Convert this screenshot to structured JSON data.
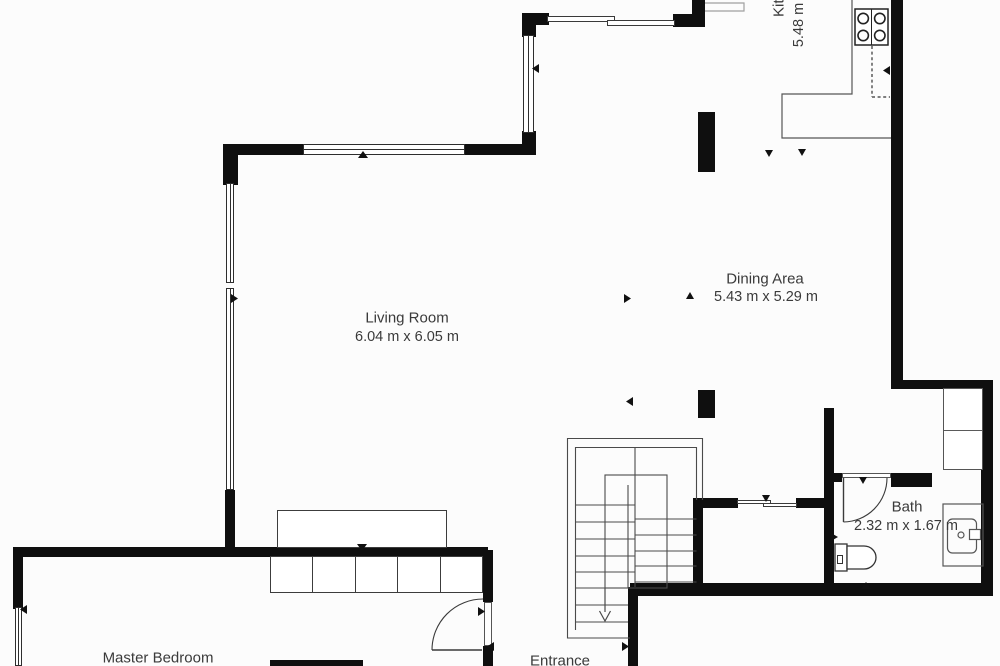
{
  "document": {
    "type": "floor-plan"
  },
  "rooms": {
    "living": {
      "name": "Living Room",
      "dims": "6.04 m x 6.05 m"
    },
    "dining": {
      "name": "Dining Area",
      "dims": "5.43 m x 5.29 m"
    },
    "kitchen": {
      "name": "Kitchen",
      "dims": "5.48 m"
    },
    "bath": {
      "name": "Bath",
      "dims": "2.32 m x 1.67 m"
    },
    "master": {
      "name": "Master Bedroom"
    },
    "entrance": {
      "name": "Entrance"
    }
  },
  "fixtures": [
    "stove-icon",
    "toilet-icon",
    "shower-icon",
    "sofa",
    "wardrobe",
    "closet",
    "staircase",
    "walk-line-arrow"
  ],
  "colors": {
    "wall": "#0f0f0f",
    "line": "#4a4a4a",
    "faint_line": "#a0a0a0",
    "text": "#3a3a3a",
    "background": "#ffffff"
  }
}
